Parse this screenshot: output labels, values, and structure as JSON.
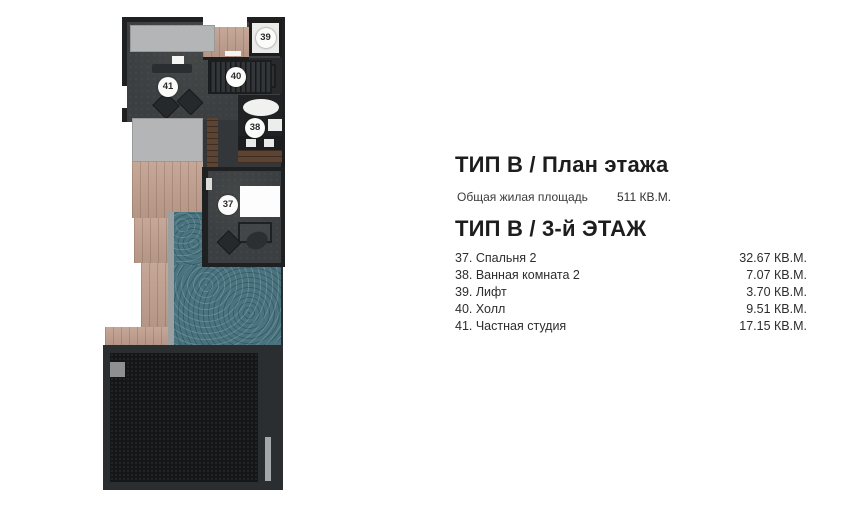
{
  "panel": {
    "title_main": "ТИП B / План этажа",
    "total_area": {
      "label": "Общая жилая площадь",
      "value": "511 КВ.М."
    },
    "title_floor": "ТИП B / 3-й ЭТАЖ",
    "rooms": [
      {
        "label": "37. Спальня 2",
        "area": "32.67 КВ.М."
      },
      {
        "label": "38. Ванная комната 2",
        "area": "7.07 КВ.М."
      },
      {
        "label": "39. Лифт",
        "area": "3.70 КВ.М."
      },
      {
        "label": "40. Холл",
        "area": "9.51 КВ.М."
      },
      {
        "label": "41. Частная студия",
        "area": "17.15 КВ.М."
      }
    ]
  },
  "plan_badges": {
    "bedroom": "37",
    "bathroom": "38",
    "elevator": "39",
    "hall": "40",
    "studio": "41"
  },
  "colors": {
    "wall": "#1e2022",
    "floor": "#3c3f42",
    "planter_gray": "#b3b5b6",
    "deck_wood": "#c2a190",
    "dark_wood": "#5c4332",
    "pool_water": "#49737e",
    "roof_frame": "#2b2e30",
    "roof_inner": "#141618",
    "elevator_fill": "#ebebe9",
    "text": "#1d1d1d"
  }
}
